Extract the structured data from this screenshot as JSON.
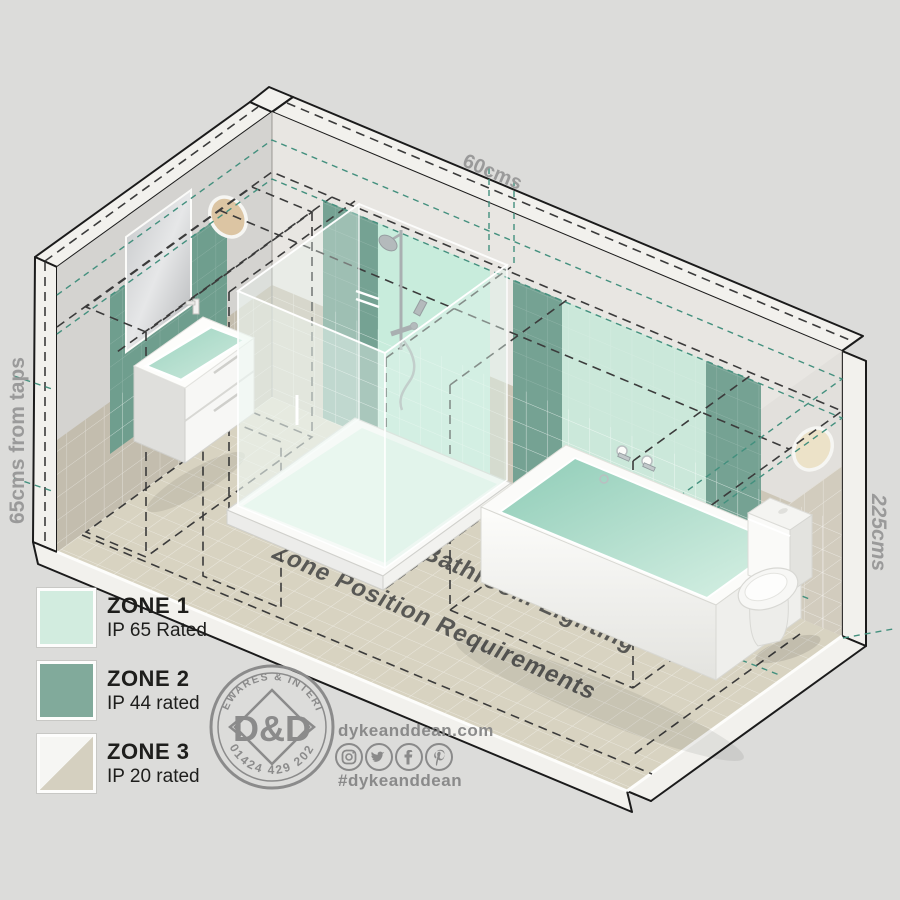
{
  "background_color": "#dcdcda",
  "room": {
    "floor_title_line1": "IP Rated Bathroom Lighting",
    "floor_title_line2": "Zone Position Requirements",
    "fixtures": [
      "mirror",
      "basin-vanity",
      "shower-enclosure",
      "bathtub",
      "toilet",
      "wall-light-left",
      "wall-light-right"
    ]
  },
  "dimensions": {
    "top": "60cms",
    "left": "65cms from taps",
    "right": "225cms"
  },
  "legend": {
    "items": [
      {
        "zone": "ZONE 1",
        "rating": "IP 65 Rated",
        "color": "#d2ecdf"
      },
      {
        "zone": "ZONE 2",
        "rating": "IP 44 rated",
        "color": "#81aa9b"
      },
      {
        "zone": "ZONE 3",
        "rating": "IP 20 rated",
        "color_top_left": "#f6f6f3",
        "color_bottom_right": "#d5d0c0"
      }
    ]
  },
  "brand": {
    "stamp": {
      "arc_top": "HOMEWARES & INTERIORS",
      "arc_bottom": "01424 429 202",
      "monogram": "D&D"
    },
    "website": "dykeanddean.com",
    "hashtag": "#dykeanddean",
    "social_icons": [
      "instagram-icon",
      "twitter-icon",
      "facebook-icon",
      "pinterest-icon"
    ]
  },
  "zone_colors": {
    "zone1_panel": "#cbe8da",
    "zone2_panel": "#7aa697",
    "zone3_tile": "#d0cabc",
    "teal_dash": "#43907e",
    "black_dash": "#3b3b3b"
  }
}
